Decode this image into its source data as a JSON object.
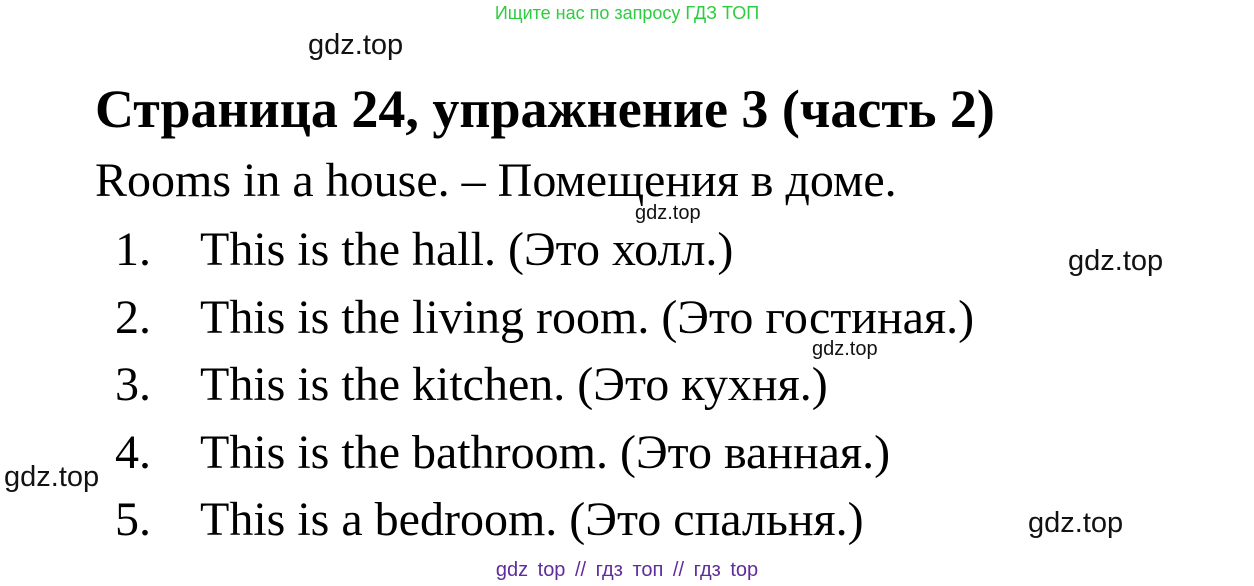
{
  "promo": {
    "text": "Ищите нас по запросу ГДЗ ТОП"
  },
  "watermark": {
    "text": "gdz.top"
  },
  "title": "Страница 24, упражнение 3 (часть 2)",
  "subtitle": "Rooms in a house. – Помещения в доме.",
  "items": [
    {
      "num": "1.",
      "text": "This is the hall. (Это холл.)"
    },
    {
      "num": "2.",
      "text": "This is the living room. (Это гостиная.)"
    },
    {
      "num": "3.",
      "text": "This is the kitchen. (Это кухня.)"
    },
    {
      "num": "4.",
      "text": "This is the bathroom. (Это ванная.)"
    },
    {
      "num": "5.",
      "text": "This is a bedroom. (Это спальня.)"
    }
  ],
  "footer": {
    "text": "gdz top // гдз топ // гдз top"
  },
  "colors": {
    "green": "#2ecc40",
    "purple": "#5e2c9c",
    "ink": "#000000",
    "paper": "#ffffff"
  }
}
